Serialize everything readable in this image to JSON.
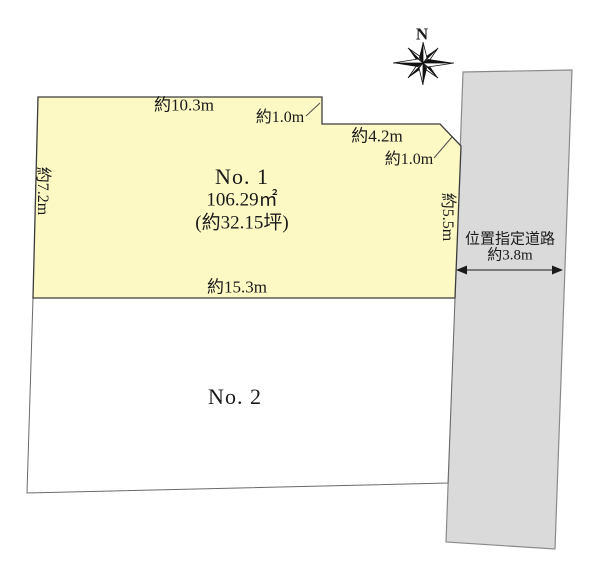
{
  "compass": {
    "label": "N"
  },
  "plot1": {
    "name": "No. 1",
    "area_m2": "106.29㎡",
    "area_tsubo": "(約32.15坪)",
    "fill": "#FCF9C5",
    "dims": {
      "top": "約10.3m",
      "step": "約1.0m",
      "upper_right": "約4.2m",
      "corner_cut": "約1.0m",
      "left": "約7.2m",
      "right": "約5.5m",
      "bottom": "約15.3m"
    }
  },
  "plot2": {
    "name": "No. 2",
    "fill": "#FFFFFF"
  },
  "road": {
    "name": "位置指定道路",
    "width": "約3.8m",
    "fill": "#DADADA"
  },
  "colors": {
    "outline": "#4d4d4d",
    "road_outline": "#8a8a8a",
    "ink": "#1a1a1a"
  }
}
